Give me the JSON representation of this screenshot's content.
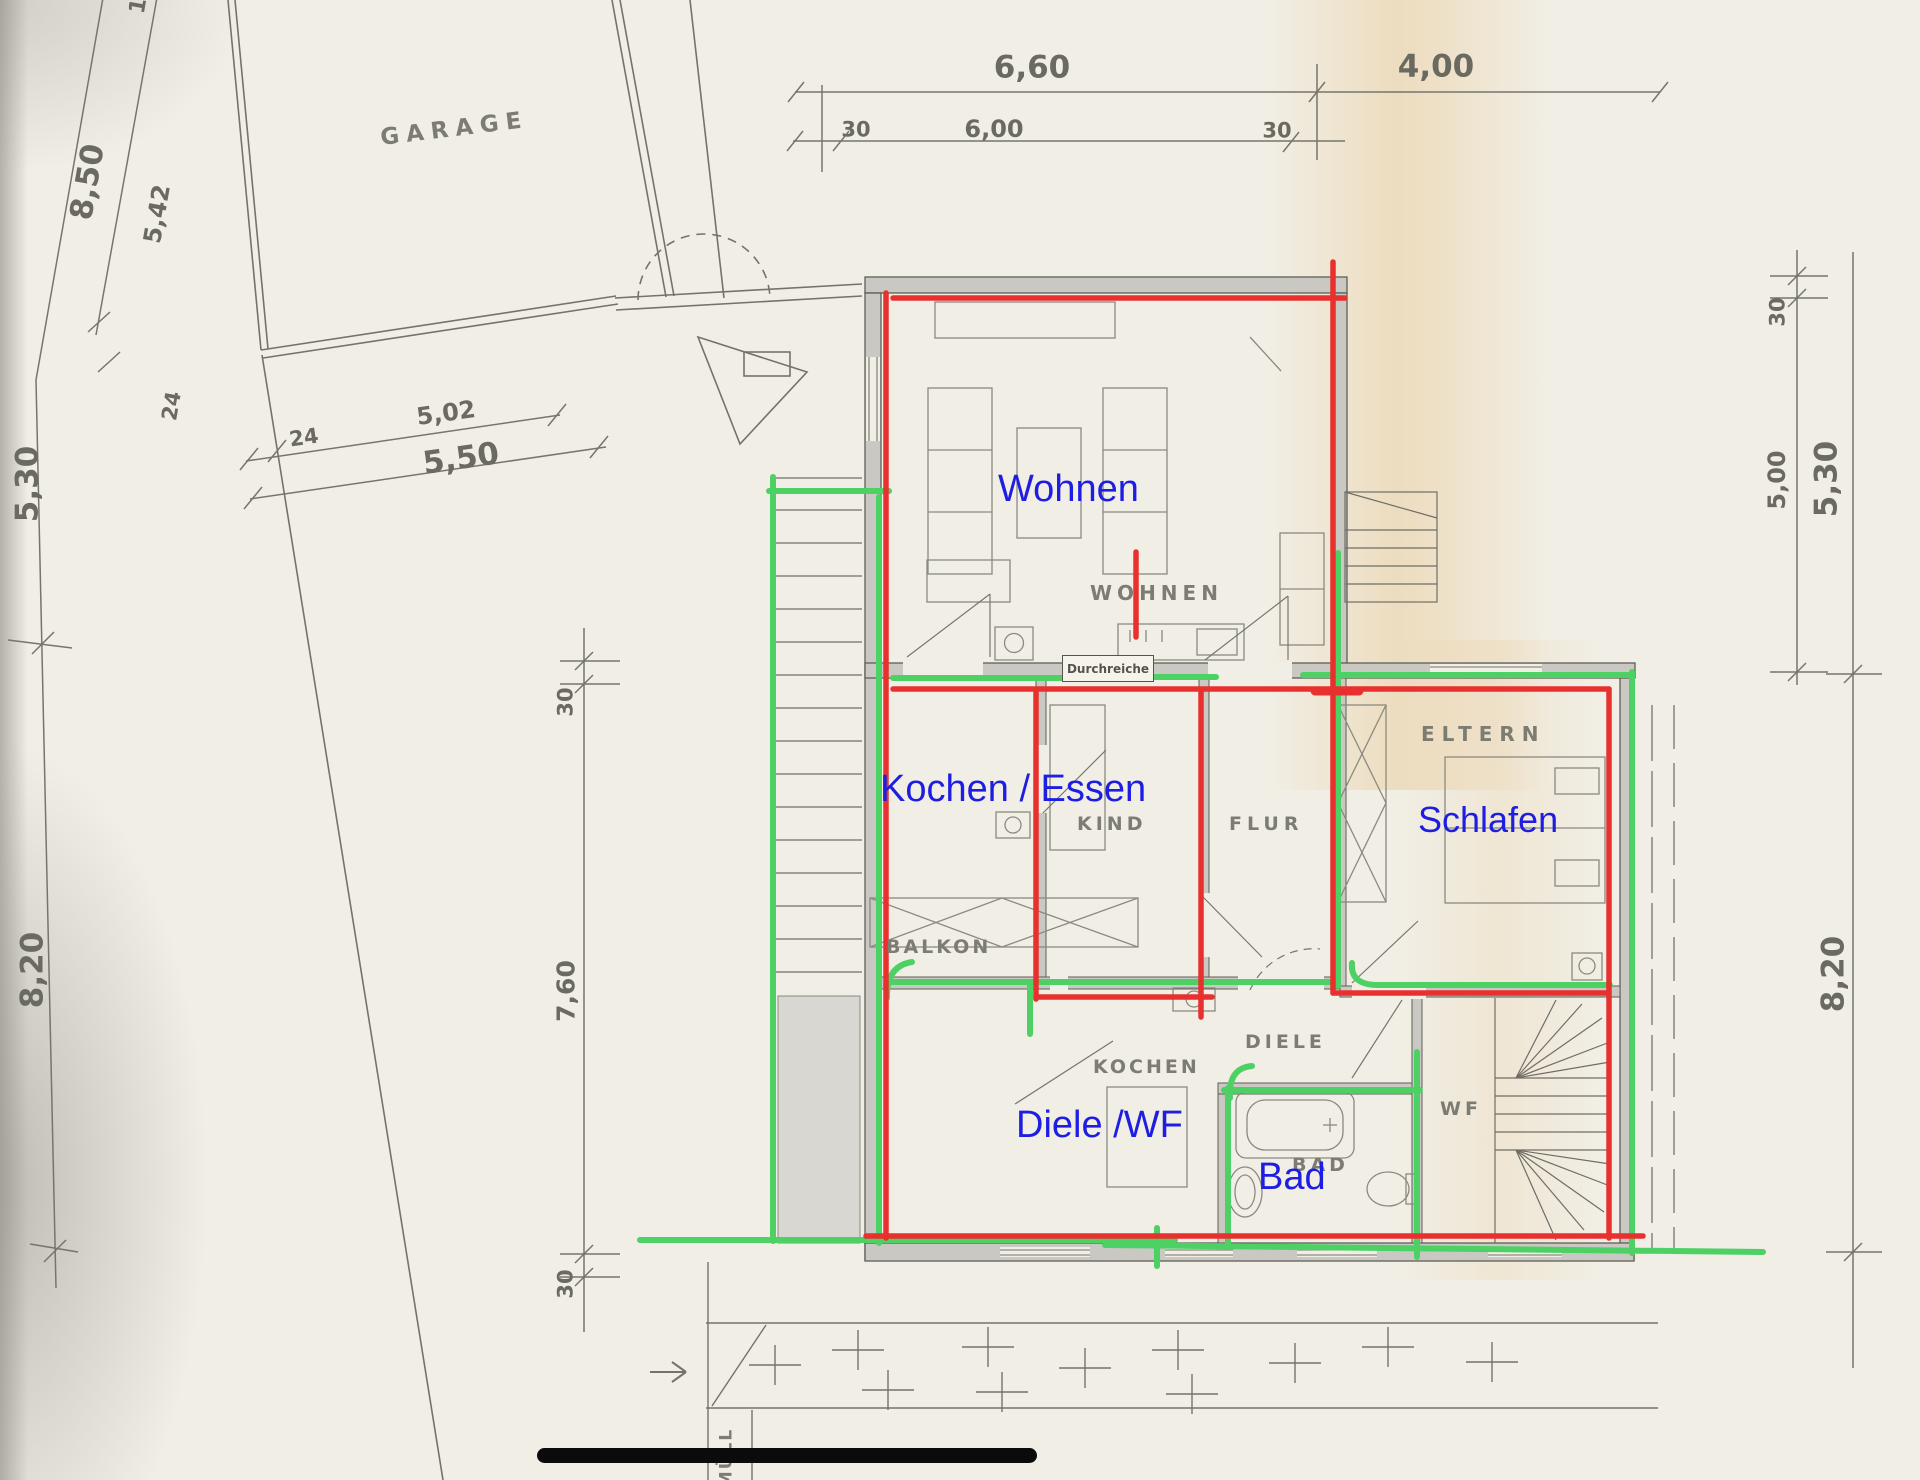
{
  "colors": {
    "annotation_red": "#e8302e",
    "annotation_green": "#4ed164",
    "annotation_blue": "#1e1ee2",
    "paper": "#f1eee5",
    "wall_fill": "#c9c8c3",
    "plan_line_gray": "#74736a",
    "black_bar": "#0b0b0b"
  },
  "labels": {
    "blue": {
      "wohnen": "Wohnen",
      "kochen_essen": "Kochen / Essen",
      "schlafen": "Schlafen",
      "diele_wf": "Diele /WF",
      "bad": "Bad"
    },
    "printed": {
      "garage": "GARAGE",
      "wohnen": "WOHNEN",
      "kind": "KIND",
      "flur": "FLUR",
      "eltern": "ELTERN",
      "balkon": "BALKON",
      "kochen": "KOCHEN",
      "diele": "DIELE",
      "bad": "BAD",
      "wf": "WF",
      "muell": "MÜLL",
      "durchreiche": "Durchreiche"
    }
  },
  "dimensions": {
    "top": {
      "total": "6,60",
      "left_wall": "30",
      "clear": "6,00",
      "right_wall": "30",
      "adjacent": "4,00"
    },
    "upper_left": {
      "garage_total": "8,50",
      "garage_clear": "5,42",
      "wall": "24",
      "partial": "1"
    },
    "below_garage": {
      "wall": "24",
      "clear": "5,02",
      "total": "5,50"
    },
    "left": {
      "upper": "5,30",
      "lower": "8,20"
    },
    "inner_left": {
      "wall_top": "30",
      "clear": "7,60",
      "wall_bottom": "30"
    },
    "right": {
      "wall_top": "30",
      "clear": "5,00",
      "total": "5,30",
      "lower": "8,20"
    }
  }
}
